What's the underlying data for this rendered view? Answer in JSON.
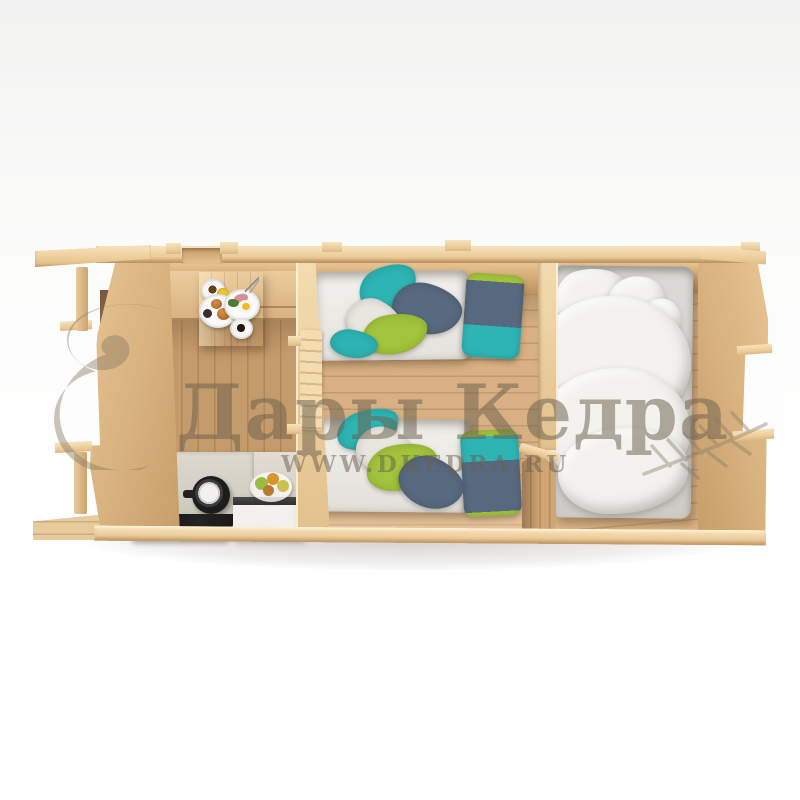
{
  "meta": {
    "type": "3d-product-render",
    "subject": "top-down cutaway view of a long rectangular wooden log cabin with three rooms"
  },
  "watermark": {
    "brand": "Дары Кедра",
    "url": "WWW.DKEDRA.RU"
  },
  "palette": {
    "wood_cream": "#f2d8a9",
    "wood_mid": "#d3ab78",
    "wood_dark": "#b98e5e",
    "linen": "#f3f2ef",
    "teal": "#2db4b3",
    "green": "#a2c33c",
    "slate": "#57697e",
    "counter": "#d6d2c7",
    "appliance_black": "#181818",
    "watermark": "rgba(108,96,76,0.52)"
  },
  "scene": {
    "rooms": [
      {
        "id": "dining-kitchen",
        "furniture": [
          "corner-bench",
          "breakfast-table",
          "breakfast-plates",
          "kitchen-counter",
          "cooktop",
          "kettle",
          "mini-fridge",
          "fruit-plate"
        ]
      },
      {
        "id": "twin-bedroom",
        "furniture": [
          "single-bed-top",
          "single-bed-bottom",
          "two-tone-pillows",
          "throw-blankets"
        ]
      },
      {
        "id": "double-bedroom",
        "furniture": [
          "double-bed",
          "white-pillows",
          "white-duvet"
        ]
      }
    ],
    "openings": [
      "entrance-door-top",
      "left-window",
      "right-window"
    ]
  }
}
